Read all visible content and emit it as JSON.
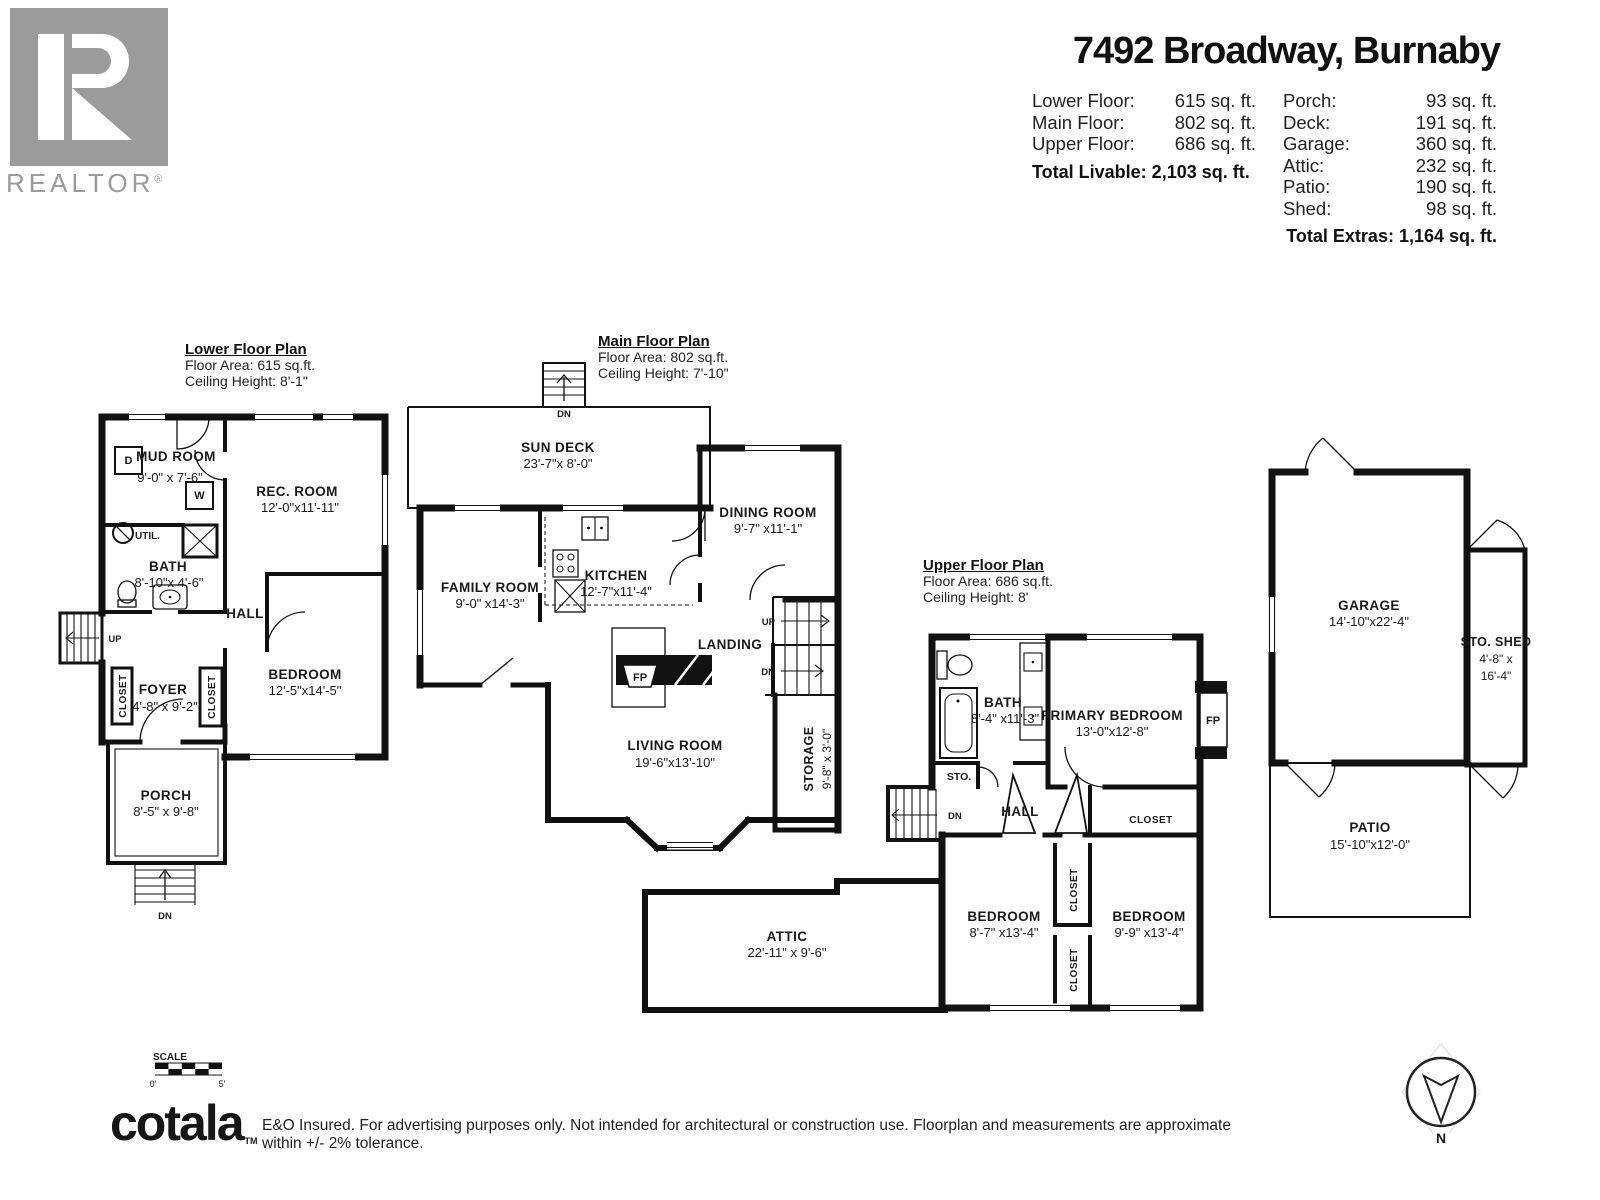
{
  "header": {
    "title": "7492 Broadway, Burnaby",
    "rows_left": [
      {
        "label": "Lower Floor:",
        "value": "615 sq. ft."
      },
      {
        "label": "Main Floor:",
        "value": "802 sq. ft."
      },
      {
        "label": "Upper Floor:",
        "value": "686 sq. ft."
      }
    ],
    "total_livable": "Total Livable: 2,103 sq. ft.",
    "rows_right": [
      {
        "label": "Porch:",
        "value": "93 sq. ft."
      },
      {
        "label": "Deck:",
        "value": "191 sq. ft."
      },
      {
        "label": "Garage:",
        "value": "360 sq. ft."
      },
      {
        "label": "Attic:",
        "value": "232 sq. ft."
      },
      {
        "label": "Patio:",
        "value": "190 sq. ft."
      },
      {
        "label": "Shed:",
        "value": "98 sq. ft."
      }
    ],
    "total_extras": "Total Extras: 1,164 sq. ft."
  },
  "branding": {
    "r": "R",
    "realtor": "REALTOR",
    "reg": "®"
  },
  "plans": {
    "lower": {
      "title": "Lower Floor Plan",
      "area": "Floor Area: 615 sq.ft.",
      "ceiling": "Ceiling Height: 8'-1\"",
      "labels": {
        "mud_name": "MUD ROOM",
        "mud_dims": "9'-0\" x 7'-6\"",
        "rec_name": "REC. ROOM",
        "rec_dims": "12'-0\"x11'-11\"",
        "util": "UTIL.",
        "bath_name": "BATH",
        "bath_dims": "8'-10\"x 4'-6\"",
        "hall": "HALL",
        "up": "UP",
        "closet1": "CLOSET",
        "closet2": "CLOSET",
        "foyer_name": "FOYER",
        "foyer_dims": "4'-8\" x 9'-2\"",
        "bed_name": "BEDROOM",
        "bed_dims": "12'-5\"x14'-5\"",
        "porch_name": "PORCH",
        "porch_dims": "8'-5\" x 9'-8\"",
        "dn": "DN",
        "d": "D",
        "w": "W"
      }
    },
    "main": {
      "title": "Main Floor Plan",
      "area": "Floor Area: 802 sq.ft.",
      "ceiling": "Ceiling Height: 7'-10\"",
      "labels": {
        "dn_top": "DN",
        "deck_name": "SUN DECK",
        "deck_dims": "23'-7\"x 8'-0\"",
        "dining_name": "DINING ROOM",
        "dining_dims": "9'-7\" x11'-1\"",
        "family_name": "FAMILY ROOM",
        "family_dims": "9'-0\" x14'-3\"",
        "kitchen_name": "KITCHEN",
        "kitchen_dims": "12'-7\"x11'-4\"",
        "landing": "LANDING",
        "up": "UP",
        "dn": "DN",
        "fp": "FP",
        "living_name": "LIVING ROOM",
        "living_dims": "19'-6\"x13'-10\"",
        "storage_name": "STORAGE",
        "storage_dims": "9'-8\" x 3'-0\""
      }
    },
    "upper": {
      "title": "Upper Floor Plan",
      "area": "Floor Area: 686 sq.ft.",
      "ceiling": "Ceiling Height: 8'",
      "labels": {
        "bath_name": "BATH",
        "bath_dims": "8'-4\" x11'-3\"",
        "primary_name": "PRIMARY BEDROOM",
        "primary_dims": "13'-0\"x12'-8\"",
        "fp": "FP",
        "sto": "STO.",
        "dn": "DN",
        "hall": "HALL",
        "closet": "CLOSET",
        "bed1_name": "BEDROOM",
        "bed1_dims": "8'-7\" x13'-4\"",
        "bed2_name": "BEDROOM",
        "bed2_dims": "9'-9\" x13'-4\"",
        "closet1": "CLOSET",
        "closet2": "CLOSET",
        "attic_name": "ATTIC",
        "attic_dims": "22'-11\" x 9'-6\""
      }
    }
  },
  "extras": {
    "labels": {
      "garage_name": "GARAGE",
      "garage_dims": "14'-10\"x22'-4\"",
      "shed_name": "STO. SHED",
      "shed_dims1": "4'-8\" x",
      "shed_dims2": "16'-4\"",
      "patio_name": "PATIO",
      "patio_dims": "15'-10\"x12'-0\""
    }
  },
  "footer": {
    "scale": "SCALE",
    "zero": "0'",
    "five": "5'",
    "logo": "cotala",
    "tm": "TM",
    "disclaimer": "E&O Insured. For advertising purposes only. Not intended for architectural or construction use. Floorplan and measurements are approximate within +/- 2% tolerance.",
    "north": "N"
  }
}
